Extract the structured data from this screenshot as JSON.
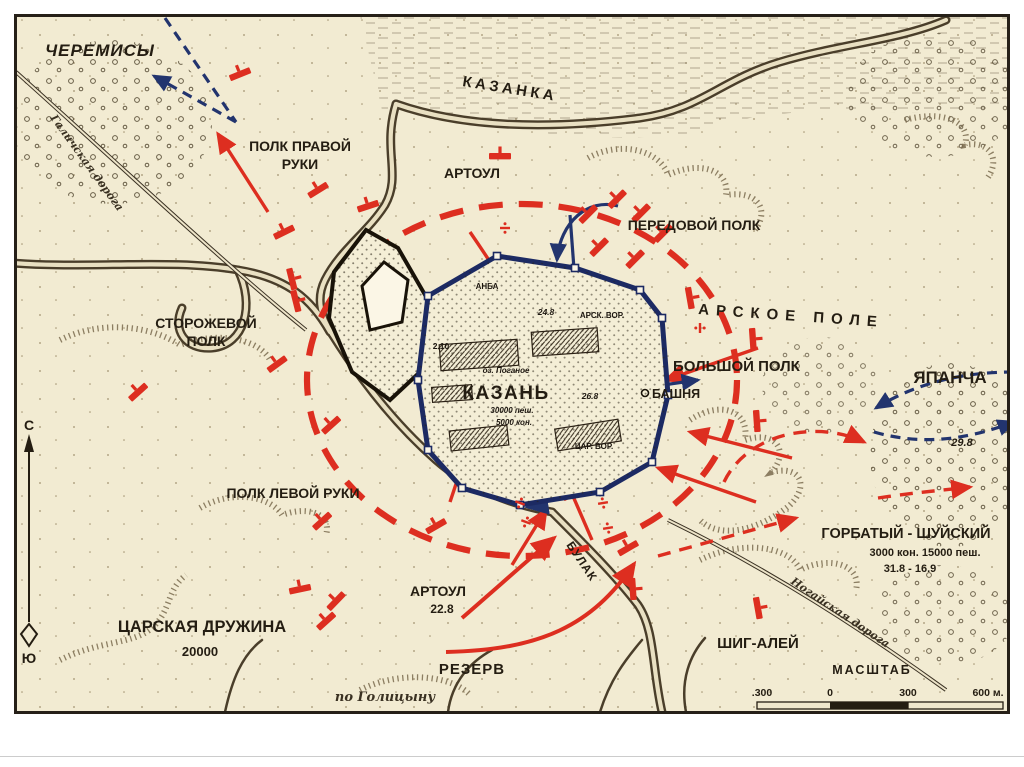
{
  "labels": {
    "cheremisy": "ЧЕРЕМИСЫ",
    "kazanka_river": "КАЗАНКА",
    "polk_pravoy_line1": "ПОЛК ПРАВОЙ",
    "polk_pravoy_line2": "РУКИ",
    "artoul_north": "АРТОУЛ",
    "peredovoy_polk": "ПЕРЕДОВОЙ ПОЛК",
    "arskoe_pole": "АРСКОЕ ПОЛЕ",
    "storozhevoy_line1": "СТОРОЖЕВОЙ",
    "storozhevoy_line2": "ПОЛК",
    "bolshoy_polk": "БОЛЬШОЙ ПОЛК",
    "bashnya": "БАШНЯ",
    "kazan": "КАЗАНЬ",
    "yapancha": "ЯПАНЧА",
    "yapancha_date": "29.8",
    "polk_levoy": "ПОЛК ЛЕВОЙ РУКИ",
    "gorbaty_shuysky": "ГОРБАТЫЙ - ШУЙСКИЙ",
    "gorbaty_strength": "3000 кон. 15000 пеш.",
    "gorbaty_dates": "31.8 - 16.9",
    "artoul_south": "АРТОУЛ",
    "artoul_south_date": "22.8",
    "rezerv": "РЕЗЕРВ",
    "tsarskaya_druzhina": "ЦАРСКАЯ ДРУЖИНА",
    "tsarskaya_strength": "20000",
    "shig_aley": "ШИГ-АЛЕЙ",
    "bulak_river": "БУЛАК",
    "galich_road": "Галичская дорога",
    "nogai_road": "Ногайская дорога",
    "source_note": "по Голицыну"
  },
  "city": {
    "gate_top": "АНБА",
    "date_24_8": "24.8",
    "arsk_gate": "АРСК. ВОР.",
    "date_2_10": "2.10",
    "lake": "оз. Поганое",
    "date_26_8": "26.8",
    "strength_line1": "30000 пеш.",
    "strength_line2": "5000 кон.",
    "tsar_gate": "ЦАР. ВОР."
  },
  "scale_bar": {
    "title": "МАСШТАБ",
    "left": ".300",
    "zero": "0",
    "right": "300",
    "end": "600 м."
  },
  "compass": {
    "north": "С",
    "south": "Ю"
  },
  "colors": {
    "paper": "#f2ebd2",
    "ink": "#2b241a",
    "attack_red": "#dd2e20",
    "defender_blue": "#22346e",
    "wall_blue": "#1c2a63"
  }
}
